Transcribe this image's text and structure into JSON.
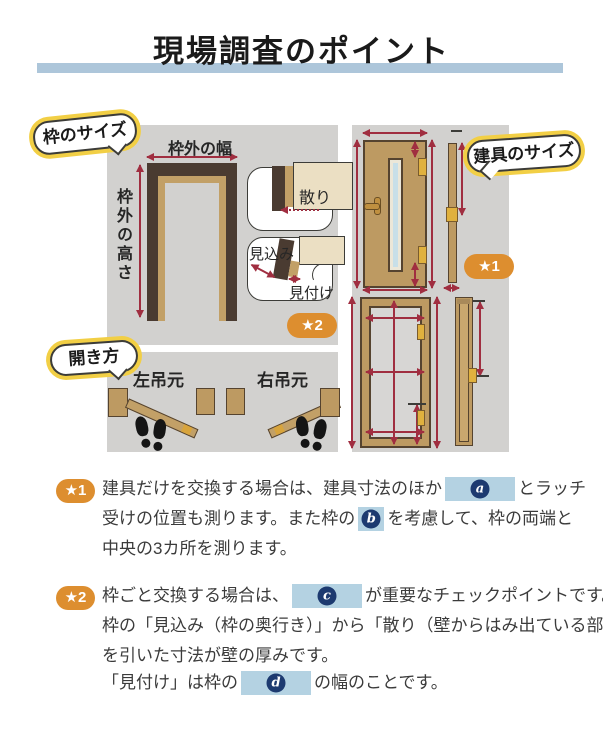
{
  "page": {
    "title": "現場調査のポイント"
  },
  "colors": {
    "accent_bar": "#adc6da",
    "panel_bg": "#d2d1cf",
    "badge_orange": "#dd8e2f",
    "arrow_red": "#a02e40",
    "highlight_blue": "#b4d2e2",
    "marker_navy": "#1d3a70",
    "bubble_yellow": "#f2cf45",
    "door_tan": "#bd9a62",
    "frame_brown": "#4a3b31",
    "wall_cream": "#ebdfc3"
  },
  "frame_panel": {
    "bubble": "枠のサイズ",
    "width_label": "枠外の幅",
    "height_label": "枠外の高さ",
    "chiri": "散り",
    "mikomi": "見込み",
    "mitsuke": "見付け",
    "badge": "★2"
  },
  "opening_panel": {
    "bubble": "開き方",
    "left_hinged": "左吊元",
    "right_hinged": "右吊元"
  },
  "fitting_panel": {
    "bubble": "建具のサイズ",
    "badge": "★1"
  },
  "notes": {
    "note1": {
      "badge": "★1",
      "line1_pre": "建具だけを交換する場合は、建具寸法のほか",
      "blank_a": "a",
      "line1_post": "とラッチ",
      "line2_pre": "受けの位置も測ります。また枠の",
      "blank_b": "b",
      "line2_post": "を考慮して、枠の両端と",
      "line3": "中央の3カ所を測ります。"
    },
    "note2": {
      "badge": "★2",
      "line1_pre": "枠ごと交換する場合は、",
      "blank_c": "c",
      "line1_post": "が重要なチェックポイントです。",
      "line2": "枠の「見込み（枠の奥行き）」から「散り（壁からはみ出ている部分）」",
      "line3": "を引いた寸法が壁の厚みです。",
      "line4_pre": "「見付け」は枠の",
      "blank_d": "d",
      "line4_post": "の幅のことです。"
    }
  }
}
